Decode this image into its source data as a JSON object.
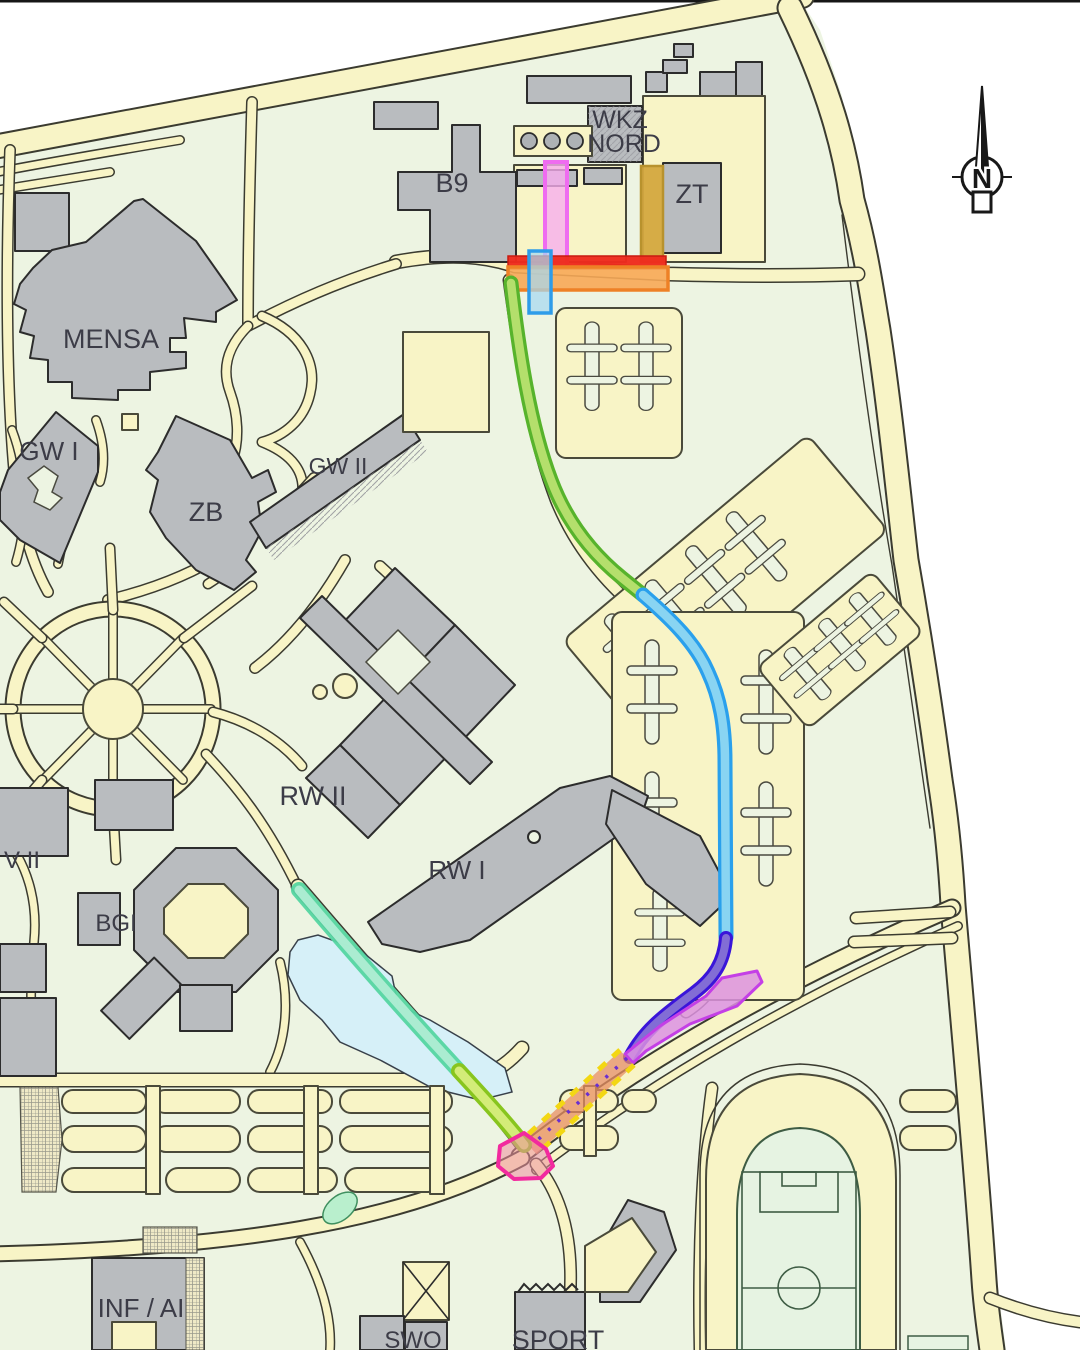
{
  "map": {
    "labels": {
      "wkz_line1": "WKZ",
      "wkz_line2": "NORD",
      "b9": "B9",
      "zt": "ZT",
      "mensa": "MENSA",
      "gw1": "GW I",
      "gw2": "GW II",
      "zb": "ZB",
      "rw2": "RW II",
      "rw1": "RW I",
      "bgi": "BGI",
      "w2": "V II",
      "inf_ai": "INF / AI",
      "swo": "SWO",
      "sport": "SPORT"
    },
    "compass": {
      "label": "N"
    },
    "routes": {
      "pink_vertical": {
        "stroke": "#ef6cf0",
        "fill": "#f6aeee"
      },
      "gold_vertical": {
        "stroke": "#b8922d",
        "fill": "#d4a83f"
      },
      "red_bar": {
        "stroke": "#c81a10",
        "fill": "#ee2b1e"
      },
      "orange_bar": {
        "stroke": "#ee8126",
        "fill": "#f7a857"
      },
      "blue_short": {
        "stroke": "#2e9ce9",
        "fill": "#a6d8f1"
      },
      "green_path": {
        "stroke": "#57b32c",
        "fill": "#b9e170"
      },
      "blue_long": {
        "stroke": "#2aa0ec",
        "fill": "#93d9f3"
      },
      "indigo_path": {
        "stroke": "#3a15d9",
        "fill": "#8f7cd4"
      },
      "orchid_overlay": {
        "stroke": "#c43fe6",
        "fill": "#dd92df"
      },
      "crossing_band": {
        "stroke": "#f3d713",
        "fill": "#e88f62",
        "dots": "#6a2fd0"
      },
      "pink_junction": {
        "stroke": "#f22a9e",
        "fill": "#ee8f9e"
      },
      "chartreuse_path": {
        "stroke": "#88c51e",
        "fill": "#d7ee7d"
      },
      "aquamarine_path": {
        "stroke": "#55d5a1",
        "fill": "#b4eed6"
      }
    },
    "base_colors": {
      "campus_bg": "#edf4e2",
      "road_fill": "#f8f4c6",
      "building_fill": "#b9bcbf",
      "outline": "#3b3b30",
      "pond": "#d6f0f8",
      "field_green": "#e6f3e2",
      "white": "#ffffff"
    }
  }
}
